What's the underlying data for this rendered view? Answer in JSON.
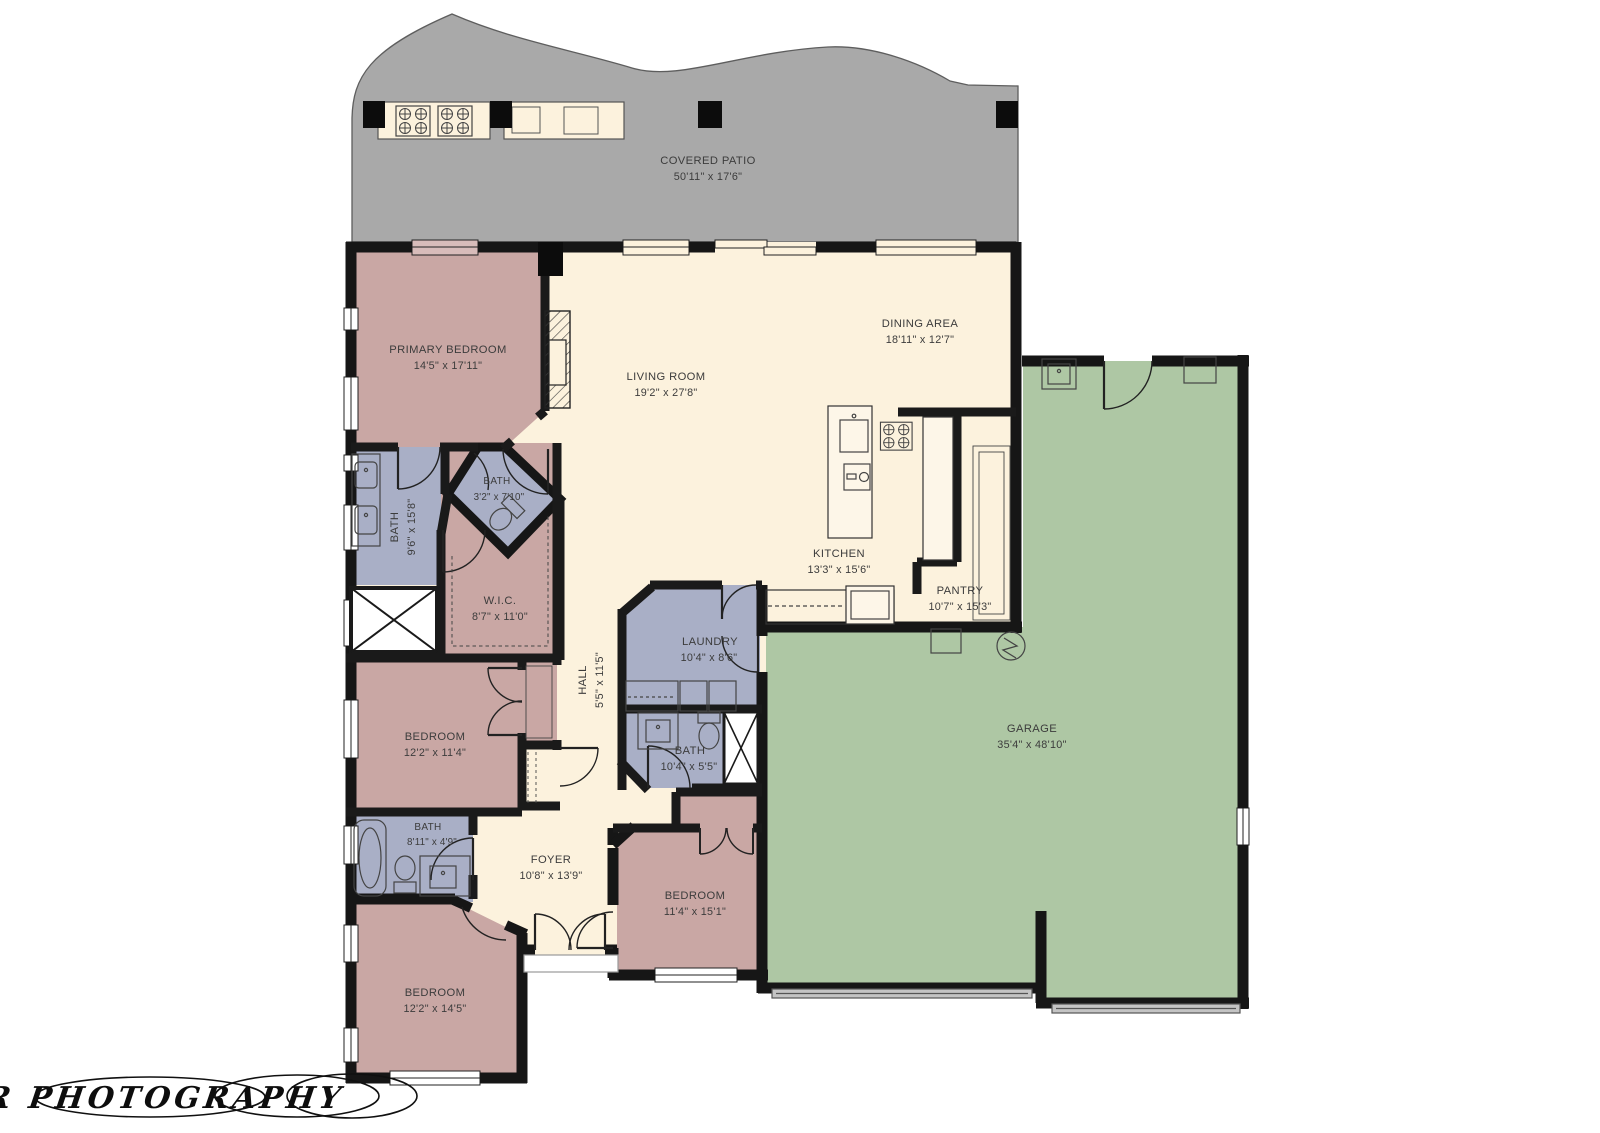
{
  "document": {
    "type": "residential-floor-plan"
  },
  "watermark": {
    "text": "Bolier Photography"
  },
  "colors": {
    "floor_cream": "#fcf2dd",
    "room_mauve": "#c9a7a4",
    "room_blue": "#a9afc6",
    "garage_green": "#aec7a4",
    "patio_gray": "#a9a9a9",
    "wall_black": "#161616",
    "label_gray": "#3c3c3c"
  },
  "rooms": [
    {
      "id": "covered-patio",
      "name": "COVERED PATIO",
      "dims": "50'11\" x 17'6\""
    },
    {
      "id": "primary-bedroom",
      "name": "PRIMARY BEDROOM",
      "dims": "14'5\" x 17'11\""
    },
    {
      "id": "living-room",
      "name": "LIVING ROOM",
      "dims": "19'2\" x 27'8\""
    },
    {
      "id": "dining-area",
      "name": "DINING AREA",
      "dims": "18'11\" x 12'7\""
    },
    {
      "id": "kitchen",
      "name": "KITCHEN",
      "dims": "13'3\" x 15'6\""
    },
    {
      "id": "pantry",
      "name": "PANTRY",
      "dims": "10'7\" x 15'3\""
    },
    {
      "id": "primary-bath",
      "name": "BATH",
      "dims": "9'6\" x 15'8\""
    },
    {
      "id": "toilet-bath",
      "name": "BATH",
      "dims": "3'2\" x 7'10\""
    },
    {
      "id": "wic",
      "name": "W.I.C.",
      "dims": "8'7\" x 11'0\""
    },
    {
      "id": "hall",
      "name": "HALL",
      "dims": "5'5\" x 11'5\""
    },
    {
      "id": "laundry",
      "name": "LAUNDRY",
      "dims": "10'4\" x 8'6\""
    },
    {
      "id": "bath-2",
      "name": "BATH",
      "dims": "10'4\" x 5'5\""
    },
    {
      "id": "bedroom-2",
      "name": "BEDROOM",
      "dims": "12'2\" x 11'4\""
    },
    {
      "id": "bath-3",
      "name": "BATH",
      "dims": "8'11\" x 4'9\""
    },
    {
      "id": "foyer",
      "name": "FOYER",
      "dims": "10'8\" x 13'9\""
    },
    {
      "id": "bedroom-3",
      "name": "BEDROOM",
      "dims": "11'4\" x 15'1\""
    },
    {
      "id": "bedroom-4",
      "name": "BEDROOM",
      "dims": "12'2\" x 14'5\""
    },
    {
      "id": "garage",
      "name": "GARAGE",
      "dims": "35'4\" x 48'10\""
    }
  ]
}
